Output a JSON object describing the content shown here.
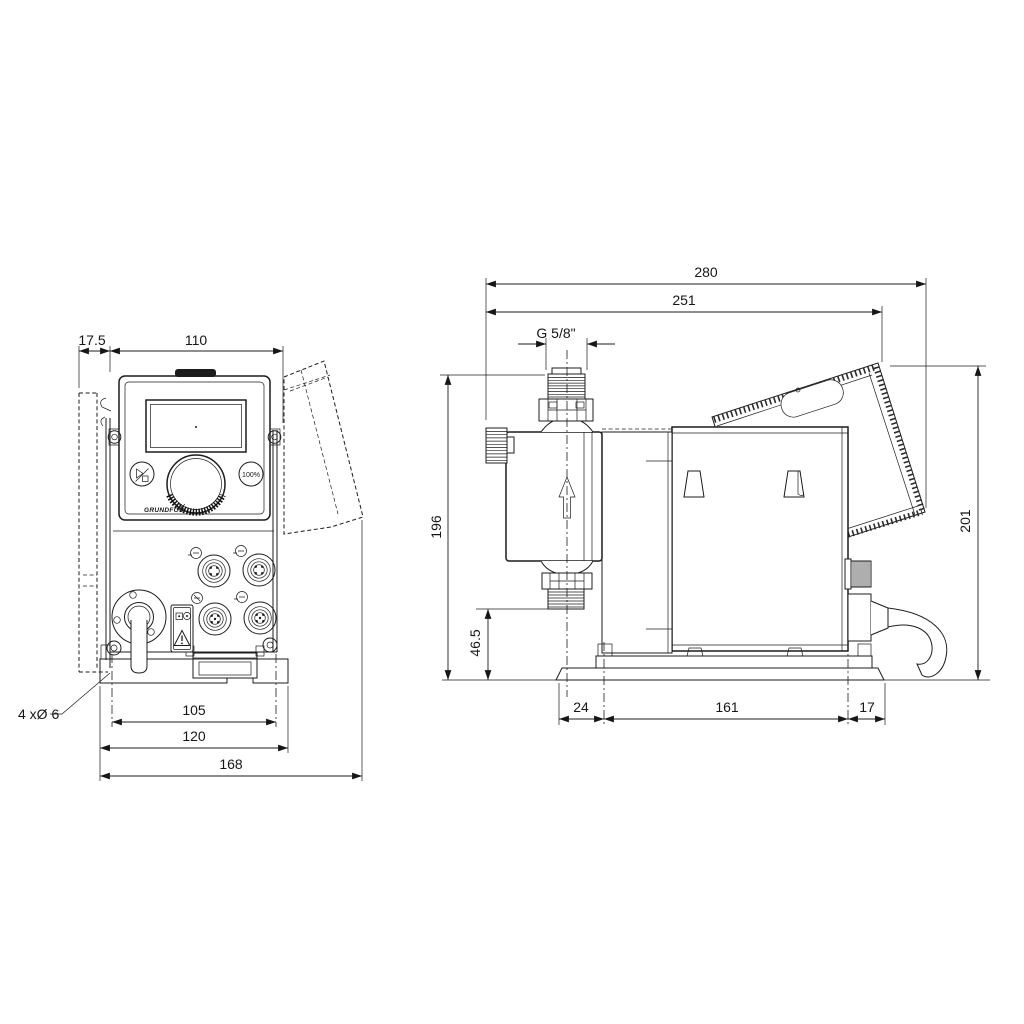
{
  "drawing_type": "dosing-pump dimensional drawing, front and side views, dimensions in mm",
  "front_view": {
    "dim_wall_clearance": "17.5",
    "dim_housing_width": "110",
    "dim_mounting_hole_spacing": "105",
    "dim_plate_width": "120",
    "dim_overall_width": "168",
    "mounting_holes_note": "4 xØ 6",
    "panel": {
      "max_button": "100%",
      "brand": "GRUNDFOS"
    }
  },
  "side_view": {
    "dim_overall_depth": "280",
    "dim_depth_to_control_cube": "251",
    "connection_thread": "G 5/8\"",
    "dim_height_to_connection": "196",
    "dim_outlet_height": "46.5",
    "dim_overall_height": "201",
    "dim_plate_front_offset": "24",
    "dim_plate_hole_spacing": "161",
    "dim_plate_rear_offset": "17"
  }
}
